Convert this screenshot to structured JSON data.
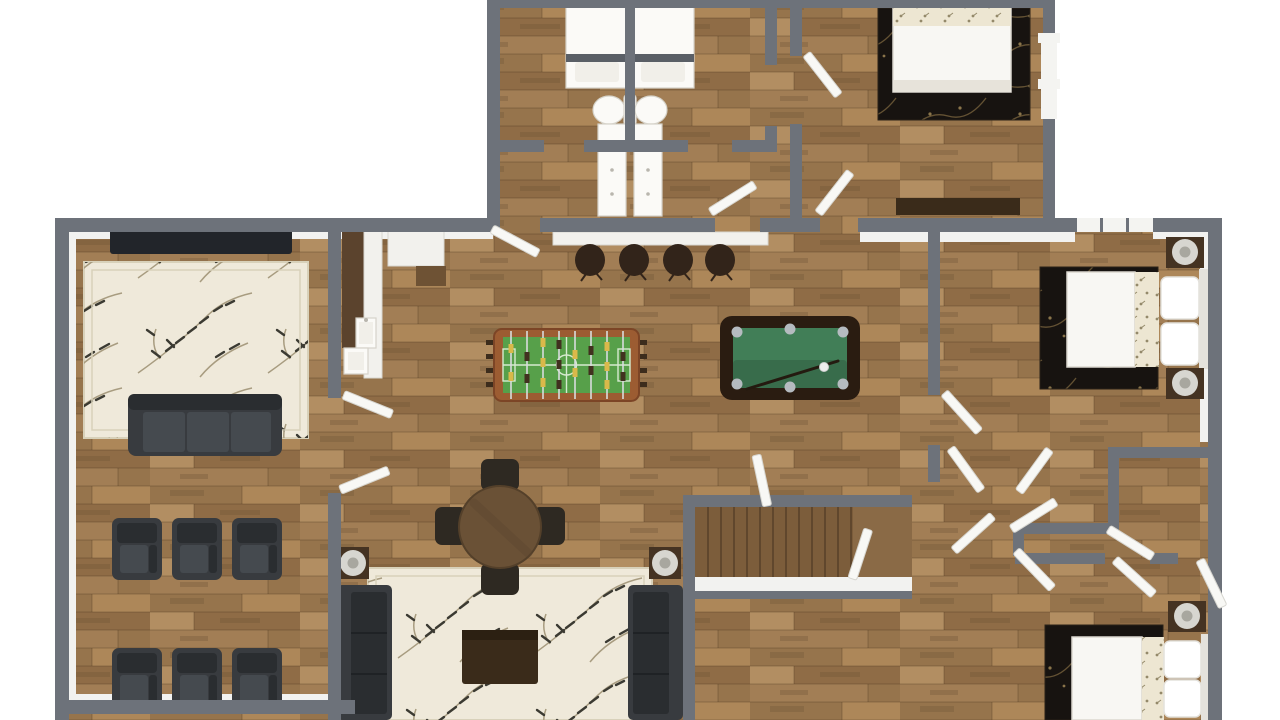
{
  "scene": {
    "title": "3D rendered top-down floor plan",
    "view": "top-down",
    "labels_visible": "none"
  },
  "rooms": [
    {
      "name": "home-theater",
      "items": [
        "wall-tv",
        "cream-floral-rug",
        "three-seat-sofa",
        "recliner-chair x6"
      ]
    },
    {
      "name": "game-room",
      "items": [
        "foosball-table",
        "pool-table",
        "bar-counter",
        "bar-stool x4",
        "kitchenette-cabinets",
        "sink"
      ]
    },
    {
      "name": "family-room",
      "items": [
        "round-dining-table",
        "dining-chair x4",
        "cream-floral-rug",
        "sofa x2",
        "end-table-with-lamp x2",
        "coffee-table"
      ]
    },
    {
      "name": "bathroom-left",
      "items": [
        "shower",
        "toilet",
        "vanity"
      ]
    },
    {
      "name": "bathroom-right",
      "items": [
        "shower",
        "toilet",
        "vanity"
      ]
    },
    {
      "name": "bedroom-top-right",
      "items": [
        "bed-with-floral-blanket",
        "dark-floral-rug",
        "dresser"
      ]
    },
    {
      "name": "bedroom-middle-right",
      "items": [
        "bed-with-pillows",
        "dark-floral-rug",
        "nightstand-with-lamp x2",
        "window"
      ]
    },
    {
      "name": "bedroom-bottom-right",
      "items": [
        "bed-with-pillows",
        "dark-floral-rug",
        "nightstand-with-lamp"
      ]
    },
    {
      "name": "staircase",
      "items": [
        "steps x12",
        "landing"
      ]
    },
    {
      "name": "hallway-closets",
      "items": [
        "open-door-leaf x9"
      ]
    }
  ],
  "colors": {
    "bg": "#ffffff",
    "wall": "#6d727a",
    "wall_face": "#f2f2f0",
    "floor_a": "#a07b53",
    "floor_b": "#96744c",
    "floor_c": "#ad8759",
    "floor_d": "#b28e62",
    "floor_a2": "#8f6c46",
    "floor_c2": "#a27e55",
    "floor_line": "rgba(62,42,22,0.30)",
    "floor_knot": "#6e5434",
    "rug_cream": "#efe9da",
    "rug_border": "#d8d1ba",
    "rug_leaf": "#3b3a32",
    "rug_branch": "#a89c80",
    "rug_dark": "#171310",
    "rug_vine": "#77613c",
    "rug_vinedot": "#8a744a",
    "sofa": "#383b3f",
    "sofa_dark": "#2a2d30",
    "sofa_light": "#454a4f",
    "tv": "#22252a",
    "wood_dark": "#3a2b1a",
    "table_brown": "#6a5136",
    "chair_dark": "#2e2922",
    "counter": "#f2f1ed",
    "counter_edge": "#d8d7d1",
    "cabinet": "#5b432d",
    "cabinet2": "#6e5234",
    "stool": "#32241a",
    "foos_frame": "#9c5c32",
    "foos_field": "#57a04a",
    "foos_line": "#d6ead0",
    "rod": "#d8dbdd",
    "player_y": "#d9b94a",
    "player_d": "#41311f",
    "handle": "#3c2c1c",
    "pool_frame": "#2a1c11",
    "pool_felt": "#417e57",
    "pool_felt_dark": "#386c4b",
    "pocket": "#b5bbc0",
    "cue": "#241a10",
    "ball": "#ededed",
    "stair": "#7c5d3b",
    "stair_line": "#5a422a",
    "landing": "#8a6a46",
    "bed_white": "#f8f7f3",
    "bed_edge": "#dcd8cf",
    "bed_floral": "#ede6d2",
    "floral_dot": "#94896a",
    "bed_foot": "#e7e3da",
    "pillow": "#ffffff",
    "headboard": "#e4e2dc",
    "nightstand": "#453322",
    "lamp": "#d7d6d0",
    "lamp_dark": "#a8a79f",
    "door": "#f8f8f5",
    "door_edge": "#d7d6d0",
    "window": "#f4f4f1",
    "glassbar": "#5a5f66",
    "fixture": "#fbfaf7",
    "fixture_edge": "#d6d3ca",
    "fixture2": "#f1efe9",
    "knob": "#b9b6ae"
  }
}
